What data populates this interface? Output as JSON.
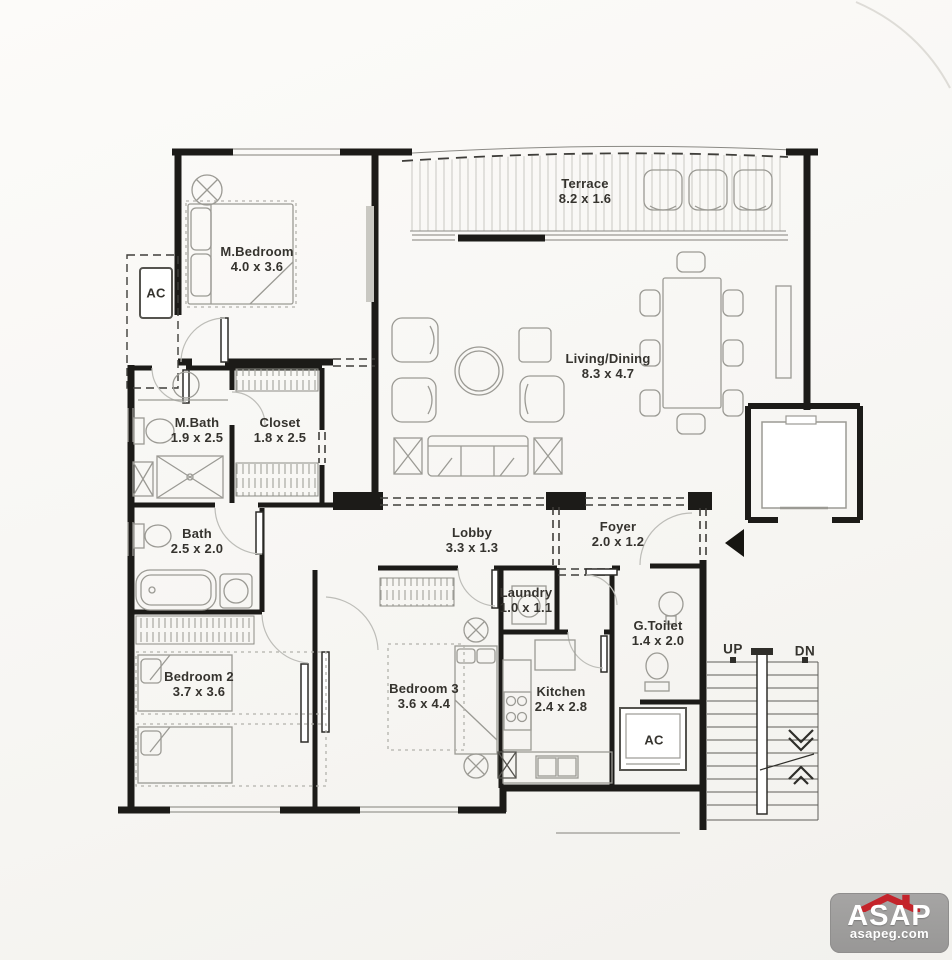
{
  "plan": {
    "title": "Apartment floor plan",
    "rooms": [
      {
        "id": "terrace",
        "name": "Terrace",
        "dims": "8.2 x 1.6"
      },
      {
        "id": "m-bedroom",
        "name": "M.Bedroom",
        "dims": "4.0 x 3.6"
      },
      {
        "id": "ac-top",
        "name": "AC",
        "dims": ""
      },
      {
        "id": "m-bath",
        "name": "M.Bath",
        "dims": "1.9 x 2.5"
      },
      {
        "id": "closet",
        "name": "Closet",
        "dims": "1.8 x 2.5"
      },
      {
        "id": "living-dining",
        "name": "Living/Dining",
        "dims": "8.3 x 4.7"
      },
      {
        "id": "bath",
        "name": "Bath",
        "dims": "2.5 x 2.0"
      },
      {
        "id": "lobby",
        "name": "Lobby",
        "dims": "3.3 x 1.3"
      },
      {
        "id": "foyer",
        "name": "Foyer",
        "dims": "2.0 x 1.2"
      },
      {
        "id": "laundry",
        "name": "Laundry",
        "dims": "1.0 x 1.1"
      },
      {
        "id": "g-toilet",
        "name": "G.Toilet",
        "dims": "1.4 x 2.0"
      },
      {
        "id": "bedroom-2",
        "name": "Bedroom 2",
        "dims": "3.7 x 3.6"
      },
      {
        "id": "bedroom-3",
        "name": "Bedroom 3",
        "dims": "3.6 x 4.4"
      },
      {
        "id": "kitchen",
        "name": "Kitchen",
        "dims": "2.4 x 2.8"
      },
      {
        "id": "ac-bottom",
        "name": "AC",
        "dims": ""
      }
    ],
    "stairs": {
      "up_label": "UP",
      "dn_label": "DN"
    },
    "colors": {
      "wall": "#1c1b18",
      "furniture": "#9b9a94",
      "dashed": "#3f3e3a"
    }
  },
  "logo": {
    "brand": "ASAP",
    "site": "asapeg.com",
    "bg": "#9d9d9c",
    "roof_color": "#c4242b",
    "text_color": "#ffffff"
  }
}
